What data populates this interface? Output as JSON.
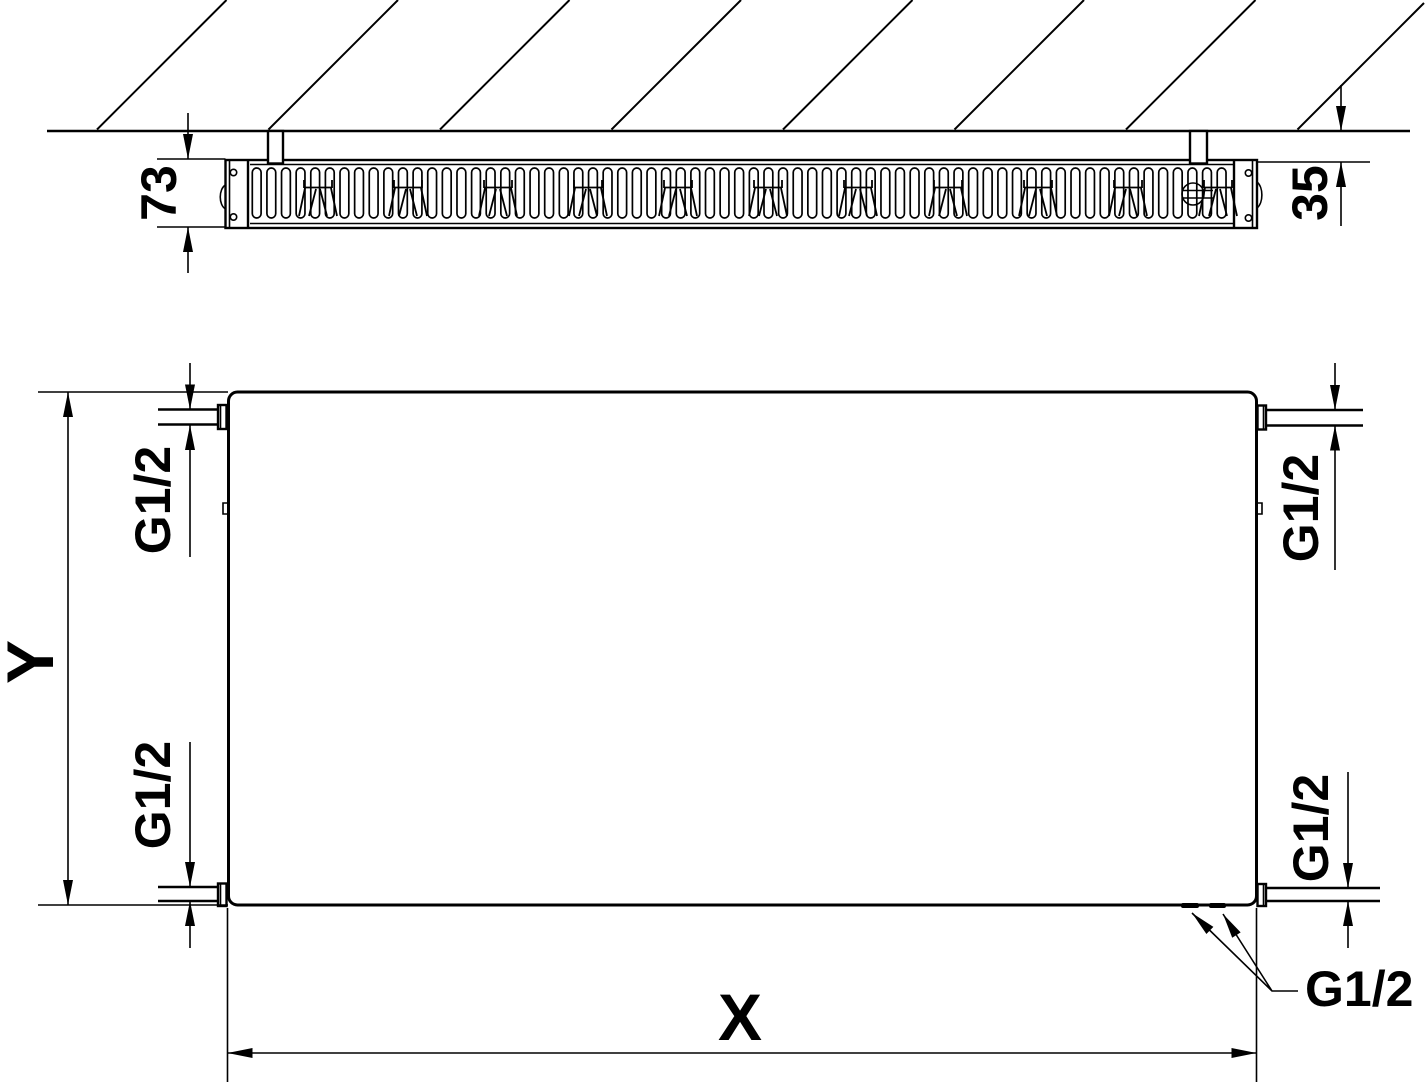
{
  "drawing": {
    "section_view": {
      "depth_label": "73",
      "wall_gap_label": "35"
    },
    "front_view": {
      "height_label": "Y",
      "width_label": "X",
      "connections": {
        "top_left": "G1/2",
        "bottom_left": "G1/2",
        "top_right": "G1/2",
        "bottom_right": "G1/2",
        "drain_leader": "G1/2"
      }
    },
    "colors": {
      "line": "#000000",
      "background": "#ffffff"
    }
  }
}
